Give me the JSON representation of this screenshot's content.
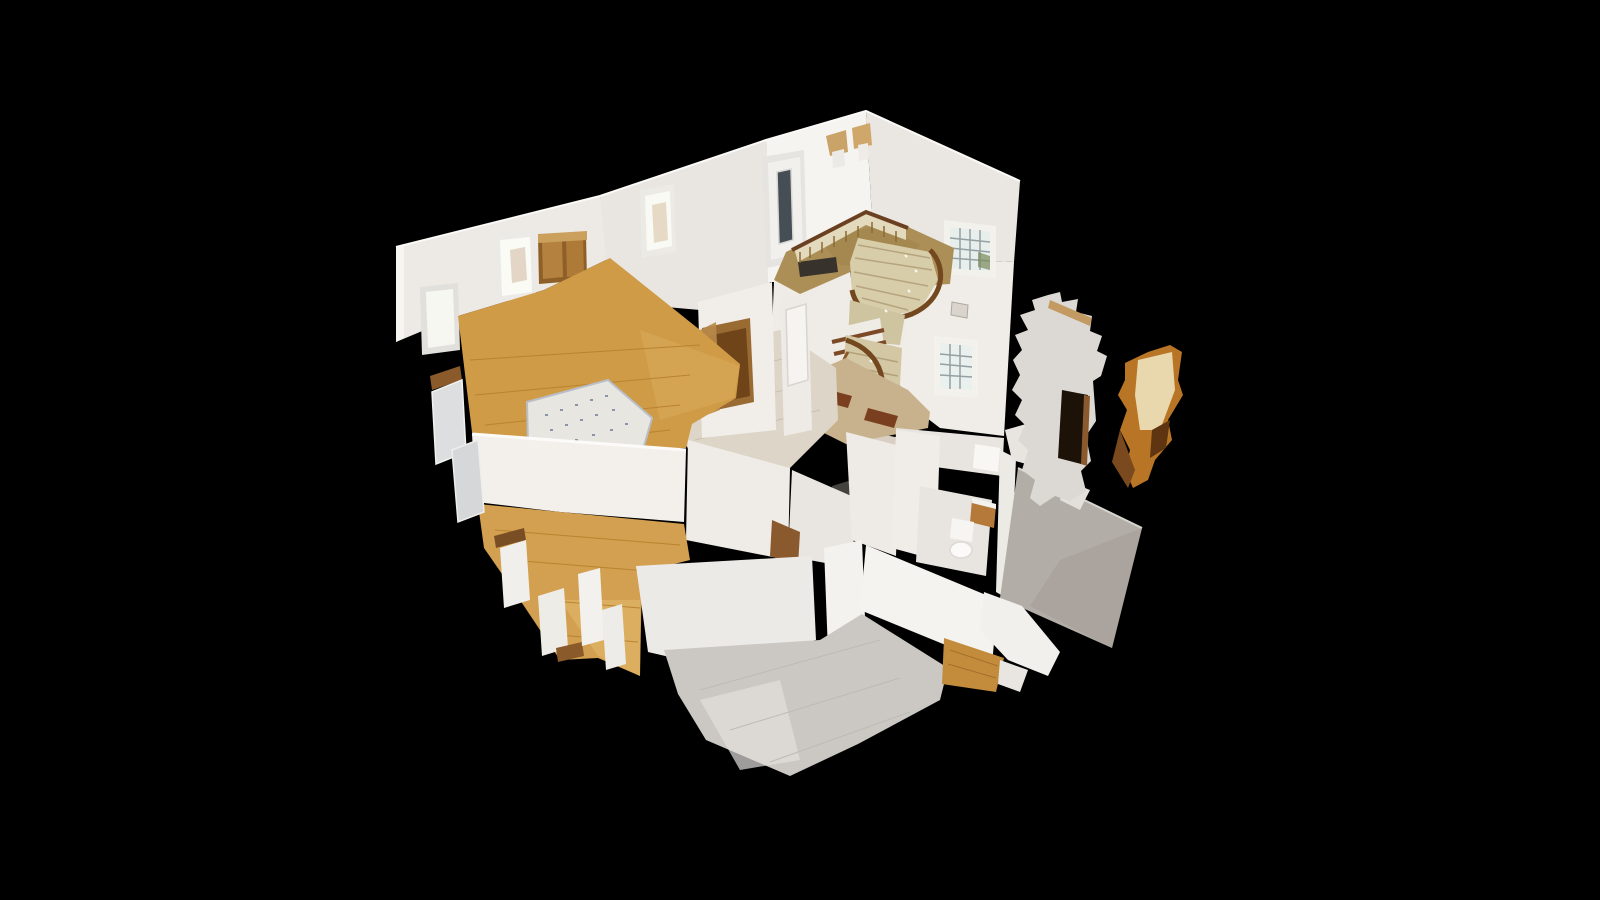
{
  "scene": {
    "kind": "3d-dollhouse-cutaway-model",
    "background": "#000000",
    "regions": [
      "entry-hall",
      "curved-staircase",
      "stairwell-windows",
      "living-room",
      "area-rug",
      "hallway",
      "second-bedroom",
      "gray-floor-kitchen",
      "bathroom",
      "basement-stairs",
      "scan-wall-fragments"
    ],
    "palette": {
      "wall_bright": "#f6f4f0",
      "wall_mid": "#ebe8e3",
      "wall_shaded": "#dcd8d2",
      "wall_gray_outer": "#b3ada7",
      "oak_floor": "#cf9b46",
      "oak_floor_light": "#e2b567",
      "gray_floor": "#cbc8c4",
      "entry_carpet": "#ab8f56",
      "stair_wood_rail": "#6f4520",
      "stair_steps": "#d6cba7",
      "marble_field": "#c8b28d",
      "marble_inset": "#7a3f1e",
      "window_glass": "#e9efee",
      "door_glass": "#454e55",
      "fragment_orange": "#b87526",
      "background": "#000000"
    },
    "shapes": [
      {
        "n": "back-wall-left",
        "p": "396,247 600,196 610,258 544,290 458,316 396,342",
        "f": "#edeae5"
      },
      {
        "n": "wall-cut-cap-left",
        "p": "396,247 404,244 404,338 396,342",
        "f": "#f7f5f2"
      },
      {
        "n": "window-left-frame",
        "p": "420,287 458,283 460,350 422,355",
        "f": "#e2e0dc"
      },
      {
        "n": "window-left-glass",
        "p": "426,292 453,289 455,344 428,348",
        "f": "#f7f7f2"
      },
      {
        "n": "window-back-frame",
        "p": "494,234 534,231 536,298 496,302",
        "f": "#eceae6"
      },
      {
        "n": "window-back-glass",
        "p": "500,240 530,237 532,292 502,296",
        "f": "#fbfbf6"
      },
      {
        "n": "window-back-warm-hint",
        "p": "510,250 525,247 527,280 512,283",
        "f": "#cbb296",
        "o": 0.5
      },
      {
        "n": "wood-double-door-frame",
        "p": "538,237 586,234 587,280 539,284",
        "f": "#8f5f28"
      },
      {
        "n": "wood-door-panel-left",
        "p": "542,241 562,240 563,277 543,279",
        "f": "#b5813e"
      },
      {
        "n": "wood-door-panel-right",
        "p": "566,239 583,238 584,276 567,277",
        "f": "#ad7a38"
      },
      {
        "n": "wood-door-lintel",
        "p": "538,234 587,231 587,240 538,243",
        "f": "#caa05c"
      },
      {
        "n": "hall-back-wall",
        "p": "600,196 766,140 770,285 700,310 610,302",
        "f": "#e9e6e1"
      },
      {
        "n": "hall-window-frame",
        "p": "640,190 674,184 676,252 642,258",
        "f": "#eceae5"
      },
      {
        "n": "hall-window-glass",
        "p": "645,196 670,191 672,246 647,251",
        "f": "#fafaf5"
      },
      {
        "n": "hall-window-figure",
        "p": "652,205 666,202 668,240 654,243",
        "f": "#d8c4a8",
        "o": 0.6
      },
      {
        "n": "entry-front-wall",
        "p": "766,140 866,111 874,255 790,282 768,282",
        "f": "#f6f4f0"
      },
      {
        "n": "entry-roof-right-wall",
        "p": "866,111 1020,181 1014,262 874,255",
        "f": "#eae6e1"
      },
      {
        "n": "stairwell-right-wall",
        "p": "874,255 1014,262 1004,436 940,428 906,402 880,330",
        "f": "#f0ece7"
      },
      {
        "n": "roof-top-edge-highlight",
        "d": "M396,247 L600,196 L766,140 L866,111 L1020,181",
        "f": "none",
        "s": "#fbfaf7",
        "w": 2
      },
      {
        "n": "front-door-frame",
        "p": "762,157 804,150 807,260 766,268",
        "f": "#e6e4e0"
      },
      {
        "n": "front-door-panel",
        "p": "768,163 800,157 803,252 771,260",
        "f": "#f1f0ed"
      },
      {
        "n": "front-door-glass-slot",
        "p": "777,172 791,169 793,240 779,244",
        "f": "#454e55",
        "s": "#d9d7d2",
        "w": 1.5
      },
      {
        "n": "sconce-flowers-1",
        "p": "826,136 846,130 848,152 830,156",
        "f": "#c9a368"
      },
      {
        "n": "sconce-pot-1",
        "p": "832,152 844,149 845,166 833,168",
        "f": "#eceae6"
      },
      {
        "n": "sconce-flowers-2",
        "p": "852,128 870,123 872,145 854,149",
        "f": "#cfa76b"
      },
      {
        "n": "sconce-pot-2",
        "p": "858,145 868,143 869,159 859,161",
        "f": "#efece8"
      },
      {
        "n": "stairwell-window-upper-frame",
        "p": "944,220 996,226 996,278 944,274",
        "f": "#f3f1ec"
      },
      {
        "n": "stairwell-window-upper-glass",
        "p": "950,227 990,232 990,271 950,268",
        "f": "#e7eeec"
      },
      {
        "n": "stairwell-window-upper-grid",
        "d": "M960,228 L960,269 M970,229 L970,270 M980,230 L980,270 M950,238 L990,242 M950,248 L990,252 M950,258 L990,261",
        "f": "none",
        "s": "#94a0a2",
        "w": 1.5
      },
      {
        "n": "stairwell-window-plant",
        "p": "978,252 990,256 990,270 978,267",
        "f": "#7a8a5a",
        "o": 0.7
      },
      {
        "n": "stairwell-window-lower-frame",
        "p": "934,336 978,340 978,398 934,395",
        "f": "#f3f1ec"
      },
      {
        "n": "stairwell-window-lower-glass",
        "p": "940,343 972,346 972,390 940,388",
        "f": "#eaf0ee"
      },
      {
        "n": "stairwell-window-lower-grid",
        "d": "M950,344 L950,389 M960,345 L960,389 M940,354 L972,357 M940,364 L972,367 M940,375 L972,377",
        "f": "none",
        "s": "#94a0a2",
        "w": 1.5
      },
      {
        "n": "picture-frame-stairwell",
        "p": "952,302 968,305 967,318 951,315",
        "f": "#d9d5ce",
        "s": "#b0a89e",
        "w": 1
      },
      {
        "n": "entry-under-wall",
        "p": "774,282 872,258 908,290 905,345 846,360 790,382 772,330",
        "f": "#efebe6"
      },
      {
        "n": "entry-carpet",
        "p": "786,252 866,212 906,226 954,248 950,284 898,287 864,266 800,294 774,280",
        "f": "#ab8f56"
      },
      {
        "n": "entry-carpet-mottling",
        "p": "820,240 880,225 920,245 900,270 840,265",
        "f": "#9c8049",
        "o": 0.45
      },
      {
        "n": "door-mat-front",
        "p": "798,262 836,257 838,272 800,277",
        "f": "#37322c"
      },
      {
        "n": "door-mat-center",
        "p": "850,271 890,266 892,281 852,286",
        "f": "#4a4136"
      },
      {
        "n": "balustrade-strip",
        "p": "794,248 866,211 906,226 906,240 866,225 798,262",
        "f": "#e3d9bc"
      },
      {
        "n": "balusters",
        "d": "M800,252 L800,263 M810,247 L810,258 M822,242 L822,253 M834,236 L834,247 M846,231 L846,242 M858,226 L858,237 M872,222 L872,233 M884,226 L884,237 M896,231 L896,242",
        "f": "none",
        "s": "#8a6a34",
        "w": 1.5
      },
      {
        "n": "handrail",
        "d": "M792,250 L866,212 L908,228",
        "f": "none",
        "s": "#6b4020",
        "w": 4
      },
      {
        "n": "stair-upper-steps",
        "p": "858,238 930,252 938,280 920,310 878,318 852,295 850,262",
        "f": "#d8cda9"
      },
      {
        "n": "stair-upper-step-lines",
        "d": "M858,245 L930,258 M855,258 L932,270 M854,272 L928,286 M856,286 L920,300 M862,298 L908,310",
        "f": "none",
        "s": "#b5a47e",
        "w": 1.5
      },
      {
        "n": "stair-upper-outer-rail",
        "d": "M930,250 C948,268 944,300 912,314 C880,326 856,312 852,290",
        "f": "none",
        "s": "#74481f",
        "w": 5
      },
      {
        "n": "stair-mid-landing",
        "p": "850,300 905,315 900,345 848,340",
        "f": "#cfc4a0"
      },
      {
        "n": "basement-stairs",
        "p": "828,330 880,318 890,388 838,398",
        "f": "#efece6"
      },
      {
        "n": "basement-stair-treads",
        "d": "M832,342 L884,330 M834,354 L886,342 M835,366 L887,354 M837,378 L888,366 M838,390 L889,378",
        "f": "none",
        "s": "#7c4a26",
        "w": 4
      },
      {
        "n": "stair-lower-steps",
        "p": "846,335 902,348 898,420 856,430 842,390",
        "f": "#d4c8a4"
      },
      {
        "n": "stair-lower-step-lines",
        "d": "M848,352 L898,362 M847,366 L898,376 M848,380 L897,390 M850,394 L896,403 M853,408 L894,415",
        "f": "none",
        "s": "#b2a17b",
        "w": 1.5
      },
      {
        "n": "stair-lower-rail-outer",
        "d": "M846,340 C884,352 892,390 872,418",
        "f": "none",
        "s": "#74481f",
        "w": 5
      },
      {
        "n": "stair-lower-rail-inner",
        "d": "M852,415 C838,400 836,370 848,352",
        "f": "none",
        "s": "#8a5a2a",
        "w": 3
      },
      {
        "n": "stair-bottom-steps",
        "p": "852,428 900,438 894,472 848,462",
        "f": "#d9cfc2"
      },
      {
        "n": "stair-bottom-step-lines",
        "d": "M852,438 L898,448 M851,448 L896,458 M850,458 L895,466",
        "f": "none",
        "s": "#8a6040",
        "w": 2
      },
      {
        "n": "chandelier-sparkle",
        "d": "M905,255 l2,2 M915,270 l2,2 M908,290 l2,2 M885,310 l2,2 M870,360 l2,2 M880,395 l2,2",
        "f": "none",
        "s": "#ffffff",
        "w": 2,
        "o": 0.9
      },
      {
        "n": "foyer-marble-floor",
        "p": "790,382 846,358 908,390 930,412 928,428 846,444 798,420",
        "f": "#c8b28d"
      },
      {
        "n": "marble-inset-tile-1",
        "p": "822,388 852,396 848,408 818,400",
        "f": "#7a3f1e"
      },
      {
        "n": "marble-inset-tile-2",
        "p": "868,408 898,416 894,428 864,420",
        "f": "#7a3f1e"
      },
      {
        "n": "hallway-floor",
        "p": "688,352 780,330 836,368 838,420 788,470 700,470 672,420",
        "f": "#ddd6c8"
      },
      {
        "n": "hallway-floor-lines",
        "d": "M690,380 L800,355 M685,410 L810,385 M695,440 L820,410",
        "f": "none",
        "s": "#c9c0ae",
        "w": 1
      },
      {
        "n": "basement-stair-hole",
        "p": "832,486 858,478 862,520 836,528",
        "f": "#44423e"
      },
      {
        "n": "hall-wall-left",
        "p": "698,302 772,282 776,430 702,438",
        "f": "#f1eee9"
      },
      {
        "n": "hall-open-door-frame",
        "p": "702,328 750,318 754,402 707,412",
        "f": "#9a6a33"
      },
      {
        "n": "hall-open-door-dark",
        "p": "708,336 746,328 750,396 712,404",
        "f": "#6e4418"
      },
      {
        "n": "hall-door-leaf",
        "p": "700,330 716,322 720,410 704,416",
        "f": "#b98a4a",
        "o": 0.9
      },
      {
        "n": "hall-wall-right",
        "p": "780,300 808,292 812,430 784,436",
        "f": "#eeebe6"
      },
      {
        "n": "hall-white-door",
        "p": "786,310 806,304 808,380 788,386",
        "f": "#f6f4f0",
        "s": "#d8d5d0",
        "w": 1.5
      },
      {
        "n": "hall-lower-wall-a",
        "p": "688,440 790,468 788,560 686,540",
        "f": "#efece7"
      },
      {
        "n": "hall-lower-wall-b",
        "p": "792,470 856,498 852,568 788,556",
        "f": "#e9e6e1"
      },
      {
        "n": "hall-lower-brown-door",
        "p": "772,520 800,532 798,566 770,556",
        "f": "#8a5a2e"
      },
      {
        "n": "toilet-room-wall",
        "p": "846,432 900,446 896,556 852,540",
        "f": "#eeebe6"
      },
      {
        "n": "living-room-floor",
        "p": "458,316 544,290 610,258 700,330 740,364 736,398 692,424 686,448 504,456 472,432",
        "f": "#cf9b46"
      },
      {
        "n": "living-floor-light-patch",
        "p": "640,330 740,366 734,398 660,420",
        "f": "#dcae5e",
        "o": 0.5
      },
      {
        "n": "living-floor-planks",
        "d": "M470,360 L700,345 M475,395 L690,375 M485,425 L680,405 M510,448 L670,430",
        "f": "none",
        "s": "#b9832f",
        "w": 1
      },
      {
        "n": "area-rug",
        "p": "527,402 608,380 652,418 644,446 560,468 528,444",
        "f": "#e8e6e1",
        "s": "#b9bec9",
        "w": 2
      },
      {
        "n": "area-rug-pattern",
        "d": "M545,415 l3,0 M560,410 l3,0 M575,405 l3,0 M590,400 l3,0 M605,396 l3,0 M550,430 l3,0 M565,425 l3,0 M580,420 l3,0 M595,415 l3,0 M612,410 l3,0 M558,445 l3,0 M575,440 l3,0 M592,435 l3,0 M610,430 l3,0 M625,424 l3,0",
        "f": "none",
        "s": "#8a93a8",
        "w": 2
      },
      {
        "n": "rug-edge-drop-shadow",
        "p": "556,462 644,446 640,470 600,488 560,478",
        "f": "#7d4d22"
      },
      {
        "n": "living-front-wall",
        "p": "472,434 686,450 684,522 560,512 476,502",
        "f": "#f3f0ec"
      },
      {
        "n": "living-front-wall-cut-edge",
        "d": "M472,434 L686,450",
        "f": "none",
        "s": "#fcfbf9",
        "w": 3
      },
      {
        "n": "bedroom2-floor",
        "p": "478,504 684,524 690,560 642,572 640,676 598,658 560,660 520,600 484,548",
        "f": "#d2a050"
      },
      {
        "n": "bedroom2-floor-bright",
        "p": "560,600 640,600 640,676 598,656",
        "f": "#e2b96a",
        "o": 0.6
      },
      {
        "n": "bedroom2-floor-planks",
        "d": "M495,530 L680,545 M510,560 L660,572 M540,600 L640,608 M560,635 L638,642",
        "f": "none",
        "s": "#b9832f",
        "w": 1
      },
      {
        "n": "cut-edge-brown-1",
        "p": "430,376 460,366 462,380 432,390",
        "f": "#8a5a2a"
      },
      {
        "n": "cut-window-frame-1",
        "p": "432,392 462,380 466,452 436,464",
        "f": "#dcdedf",
        "s": "#f2f2f0",
        "w": 1.5
      },
      {
        "n": "cut-window-frame-2",
        "p": "452,450 478,440 484,512 458,522",
        "f": "#d5d7d8",
        "s": "#eeeeec",
        "w": 1.5
      },
      {
        "n": "cut-edge-brown-2",
        "p": "494,536 524,528 526,540 496,548",
        "f": "#7a4e24"
      },
      {
        "n": "cut-radiator-1",
        "p": "500,548 526,540 530,600 504,608",
        "f": "#f1efeb"
      },
      {
        "n": "cut-radiator-2",
        "p": "538,596 564,588 568,648 542,656",
        "f": "#eeece7"
      },
      {
        "n": "cut-edge-brown-3",
        "p": "556,648 582,642 584,656 558,662",
        "f": "#8a5a2a"
      },
      {
        "n": "bedroom2-radiator-1",
        "p": "578,574 600,568 604,640 582,646",
        "f": "#f3f1ed"
      },
      {
        "n": "bedroom2-radiator-2",
        "p": "602,610 622,604 626,664 606,670",
        "f": "#eeece8"
      },
      {
        "n": "grayroom-left-wall",
        "p": "636,566 812,556 816,640 700,664 648,652",
        "f": "#eceae7"
      },
      {
        "n": "grayroom-pillar",
        "p": "824,548 862,540 866,644 828,652",
        "f": "#f4f2ee"
      },
      {
        "n": "grayroom-right-wall",
        "p": "866,545 998,600 992,664 860,610",
        "f": "#f5f3ef"
      },
      {
        "n": "grayroom-floor",
        "p": "664,650 820,640 862,614 948,668 940,700 858,744 790,776 706,740 678,694",
        "f": "#cbc8c4"
      },
      {
        "n": "grayroom-floor-sheen",
        "p": "700,700 780,680 800,760 740,770",
        "f": "#e2e0dd",
        "o": 0.7
      },
      {
        "n": "grayroom-floor-tile-lines",
        "d": "M700,690 L880,640 M730,730 L900,678 M770,762 L910,712",
        "f": "none",
        "s": "#bdbab6",
        "w": 1
      },
      {
        "n": "bathroom-back-wall",
        "p": "896,428 1004,438 1002,476 898,462",
        "f": "#e8e4df"
      },
      {
        "n": "bathroom-window-bright",
        "p": "975,444 1000,448 998,472 973,468",
        "f": "#f8f7f3"
      },
      {
        "n": "bathroom-left-wall",
        "p": "896,430 940,436 936,560 892,548",
        "f": "#f0ede8"
      },
      {
        "n": "bathroom-floor",
        "p": "920,486 992,500 986,576 916,562",
        "f": "#e8e5e1"
      },
      {
        "n": "bathroom-vanity-wood",
        "p": "972,500 996,506 994,528 970,522",
        "f": "#b5793a"
      },
      {
        "n": "bathroom-vanity-top",
        "p": "972,498 996,504 996,509 972,503",
        "f": "#f4f2ee"
      },
      {
        "n": "toilet-tank",
        "p": "952,518 974,522 972,542 950,538",
        "f": "#f6f5f2"
      },
      {
        "n": "toilet-bowl",
        "e": [
          961,
          550,
          11,
          8
        ],
        "f": "#fbfaf8",
        "s": "#dddad5",
        "w": 1.5
      },
      {
        "n": "bathroom-right-wall",
        "p": "1000,450 1016,458 1010,600 996,592",
        "f": "#eceae5"
      },
      {
        "n": "bathroom-outer-gray-wall",
        "p": "1018,468 1142,528 1112,648 1000,598",
        "f": "#b3ada7"
      },
      {
        "n": "bathroom-outer-gray-shade",
        "p": "1060,560 1142,528 1112,648 1030,606",
        "f": "#a39d97",
        "o": 0.6
      },
      {
        "n": "bathroom-outer-top-edge",
        "d": "M1018,468 L1142,528",
        "f": "none",
        "s": "#d8d4cf",
        "w": 2
      },
      {
        "n": "bathroom-bottom-fixtures",
        "p": "984,592 1022,606 1060,652 1048,676 1008,660 980,630",
        "f": "#f2f0ec"
      },
      {
        "n": "wood-strip-bottom-right",
        "p": "944,638 1004,658 996,692 942,684",
        "f": "#c28c3c"
      },
      {
        "n": "wood-strip-planks",
        "d": "M950,650 L998,666 M948,664 L996,678",
        "f": "none",
        "s": "#a5702c",
        "w": 1
      },
      {
        "n": "white-piece-bottom-right",
        "p": "1000,660 1028,670 1020,692 998,684",
        "f": "#e9e6e2"
      },
      {
        "n": "fragment-white-upper-bits",
        "p": "1005,430 1040,420 1060,445 1048,470 1012,460",
        "f": "#e8e5e1"
      },
      {
        "n": "fragment-white-small",
        "p": "1065,480 1090,490 1080,510 1060,500",
        "f": "#e3e0dc"
      },
      {
        "n": "fragment-wall-ragged",
        "p": "1048,295 1060,292 1062,302 1078,299 1076,312 1092,316 1090,331 1102,336 1097,351 1107,356 1101,376 1093,381 1096,421 1086,436 1091,461 1081,471 1086,491 1070,501 1055,496 1040,506 1030,498 1035,480 1022,470 1028,450 1018,440 1025,425 1015,415 1022,400 1012,390 1020,375 1013,360 1022,350 1015,335 1028,330 1020,315 1035,310 1032,300",
        "f": "#dcd9d5"
      },
      {
        "n": "fragment-wall-top-tan-strip",
        "p": "1050,300 1092,318 1090,326 1048,308",
        "f": "#c29a62"
      },
      {
        "n": "fragment-wall-door-hole",
        "p": "1062,390 1088,395 1085,465 1058,458",
        "f": "#1c1208"
      },
      {
        "n": "fragment-wall-door-jamb",
        "p": "1084,395 1090,396 1087,466 1081,464",
        "f": "#8a5a2e"
      },
      {
        "n": "fragment-orange",
        "p": "1125,363 1148,352 1170,345 1182,352 1178,380 1183,395 1168,420 1172,440 1155,460 1148,480 1133,488 1125,470 1130,450 1120,430 1127,410 1118,395 1125,380",
        "f": "#b87526"
      },
      {
        "n": "fragment-orange-light-patch",
        "p": "1138,360 1172,352 1175,390 1160,430 1140,430 1135,395",
        "f": "#e9d8ad"
      },
      {
        "n": "fragment-orange-dark-streak",
        "p": "1152,430 1170,420 1166,448 1150,458",
        "f": "#5f3411"
      },
      {
        "n": "fragment-orange-tail",
        "p": "1120,430 1135,470 1128,488 1112,462",
        "f": "#7a4a1e"
      }
    ]
  }
}
